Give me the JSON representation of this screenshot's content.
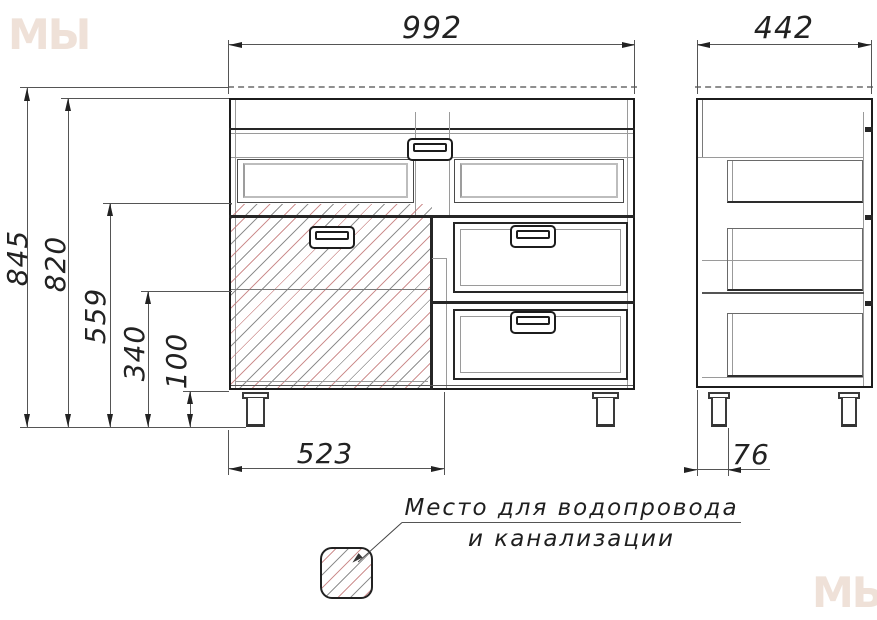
{
  "drawing": {
    "type": "furniture technical drawing, washbasin cabinet, front and side views"
  },
  "dimensions": {
    "front_width": "992",
    "side_depth": "442",
    "total_height": "845",
    "body_height": "820",
    "niche_level": "559",
    "drawer_level": "340",
    "plinth_height": "100",
    "plumbing_zone_width": "523",
    "leg_offset": "76"
  },
  "legend": {
    "line1": "Место для водопровода",
    "line2": "и канализации"
  },
  "watermark": {
    "text": "МЫ"
  },
  "colors": {
    "line": "#1c1c1c",
    "hatch_gray": "#7d7d7d",
    "hatch_red": "#c67e7e",
    "background": "#ffffff"
  }
}
